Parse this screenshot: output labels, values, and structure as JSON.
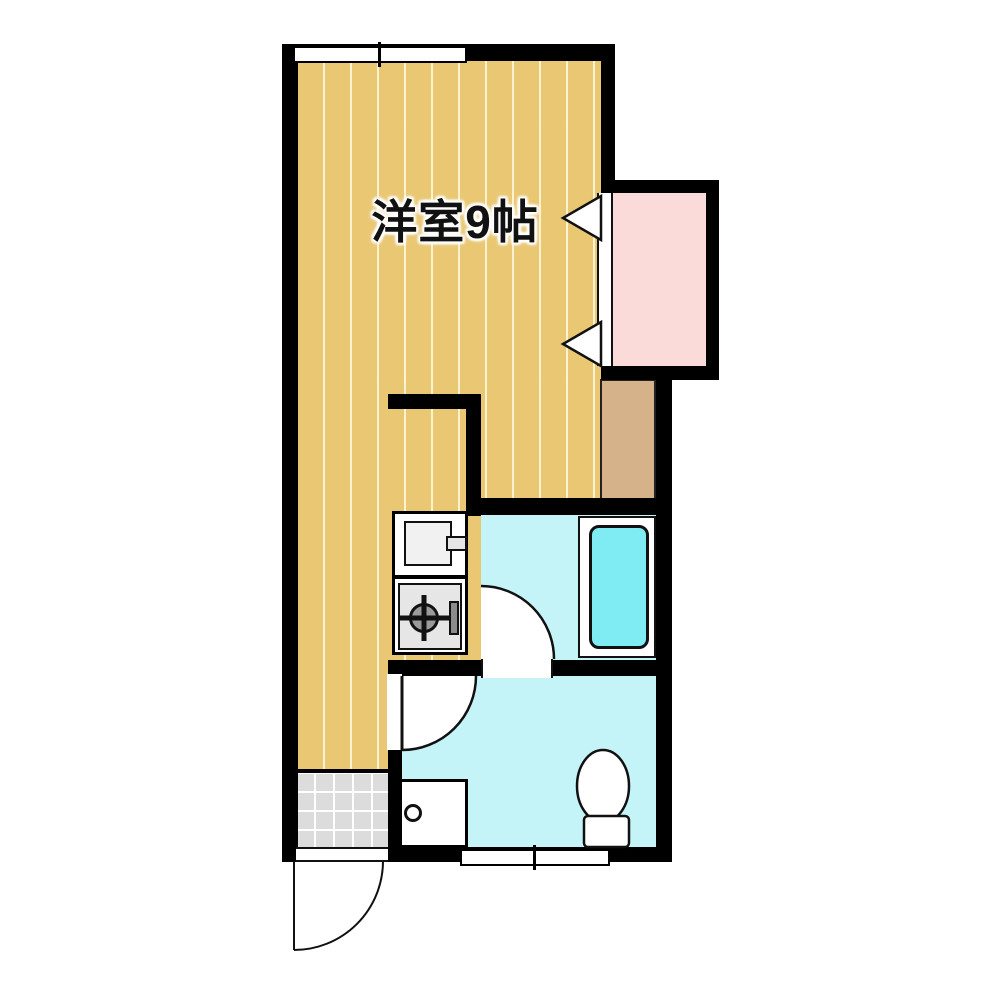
{
  "floorplan": {
    "room_label": "洋室9帖",
    "rooms": [
      {
        "name": "western-room",
        "label": "洋室9帖",
        "floor_color": "#eac873"
      },
      {
        "name": "closet",
        "label": "",
        "floor_color": "#fbdada"
      },
      {
        "name": "step-storage",
        "label": "",
        "floor_color": "#d6b28b"
      },
      {
        "name": "bathroom",
        "label": "",
        "floor_color": "#c4f4f8"
      },
      {
        "name": "toilet-washroom",
        "label": "",
        "floor_color": "#c4f4f8"
      },
      {
        "name": "entrance-genkan",
        "label": "",
        "floor_color": "#dcdcdc"
      }
    ],
    "fixtures": [
      "kitchen-sink-icon",
      "gas-stove-icon",
      "bathtub-icon",
      "toilet-icon",
      "washing-machine-pan-icon",
      "entrance-door-arc",
      "bathroom-door-arc",
      "washroom-door-arc",
      "closet-folding-door-triangles",
      "window-top",
      "window-bottom"
    ],
    "colors": {
      "wall": "#000000",
      "background": "#ffffff",
      "bathtub": "#7fecf4",
      "label_text": "#111111"
    }
  }
}
